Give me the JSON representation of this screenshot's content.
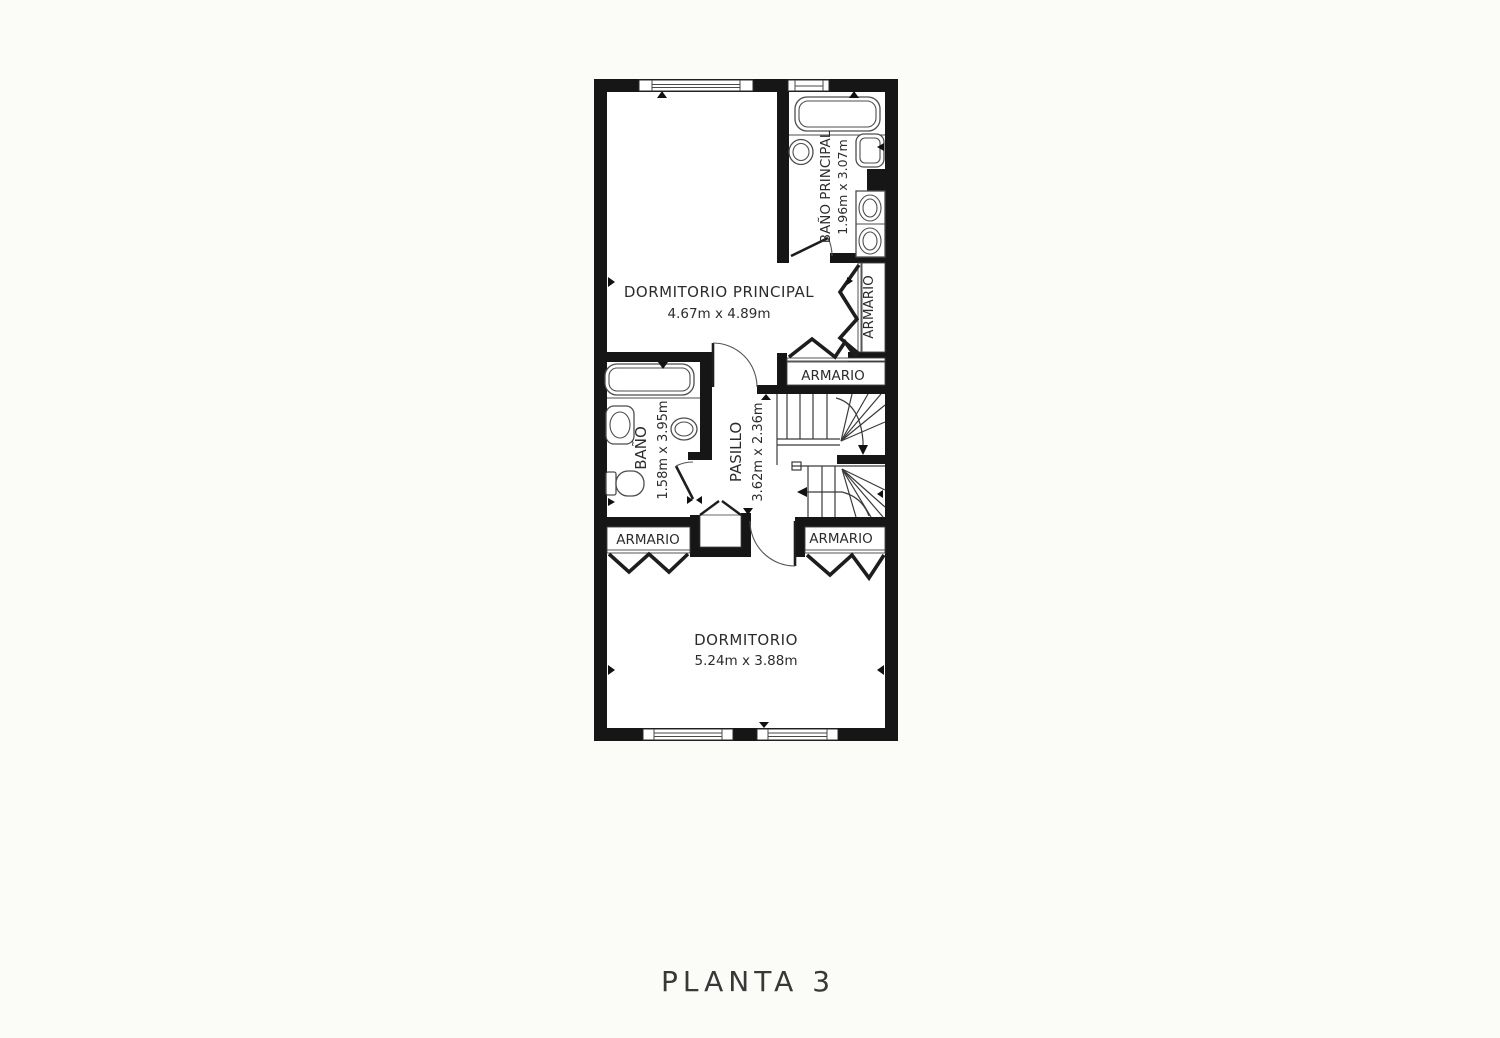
{
  "title": "PLANTA 3",
  "colors": {
    "wall": "#161616",
    "line": "#3a3a3a",
    "text": "#2c2c2c",
    "paper": "#fbfbf8"
  },
  "rooms": {
    "dormitorio_principal": {
      "name": "DORMITORIO PRINCIPAL",
      "dims": "4.67m x 4.89m"
    },
    "bano_principal": {
      "name": "BAÑO PRINCIPAL",
      "dims": "1.96m x 3.07m"
    },
    "bano": {
      "name": "BAÑO",
      "dims": "1.58m x 3.95m"
    },
    "pasillo": {
      "name": "PASILLO",
      "dims": "3.62m x 2.36m"
    },
    "dormitorio": {
      "name": "DORMITORIO",
      "dims": "5.24m x 3.88m"
    },
    "armario_hall": {
      "name": "ARMARIO"
    },
    "armario_east": {
      "name": "ARMARIO"
    },
    "armario_sw": {
      "name": "ARMARIO"
    },
    "armario_se": {
      "name": "ARMARIO"
    }
  }
}
